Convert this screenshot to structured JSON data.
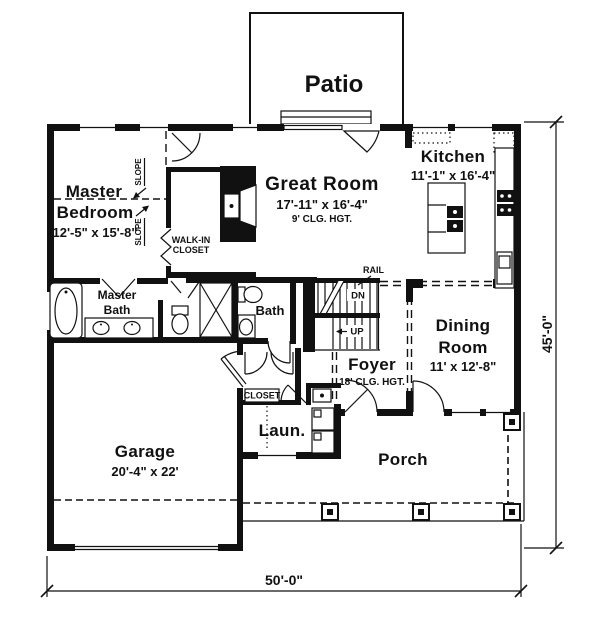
{
  "plan": {
    "patio": {
      "label": "Patio"
    },
    "master_bedroom": {
      "line1": "Master",
      "line2": "Bedroom",
      "dims": "12'-5\" x 15'-8\""
    },
    "slope": {
      "label": "SLOPE"
    },
    "walk_in_closet": {
      "line1": "WALK-IN",
      "line2": "CLOSET"
    },
    "great_room": {
      "label": "Great Room",
      "dims": "17'-11\" x 16'-4\"",
      "ceiling": "9' CLG. HGT."
    },
    "kitchen": {
      "label": "Kitchen",
      "dims": "11'-1\" x 16'-4\""
    },
    "rail": {
      "label": "RAIL"
    },
    "stairs": {
      "down": "DN",
      "up": "UP"
    },
    "master_bath": {
      "line1": "Master",
      "line2": "Bath"
    },
    "bath": {
      "label": "Bath"
    },
    "dining_room": {
      "line1": "Dining",
      "line2": "Room",
      "dims": "11' x 12'-8\""
    },
    "foyer": {
      "label": "Foyer",
      "ceiling": "18' CLG. HGT."
    },
    "closet": {
      "label": "CLOSET"
    },
    "laundry": {
      "label": "Laun."
    },
    "garage": {
      "label": "Garage",
      "dims": "20'-4\" x 22'"
    },
    "porch": {
      "label": "Porch"
    },
    "dimensions": {
      "width": "50'-0\"",
      "height": "45'-0\""
    }
  },
  "colors": {
    "line": "#111111",
    "background": "#ffffff"
  }
}
